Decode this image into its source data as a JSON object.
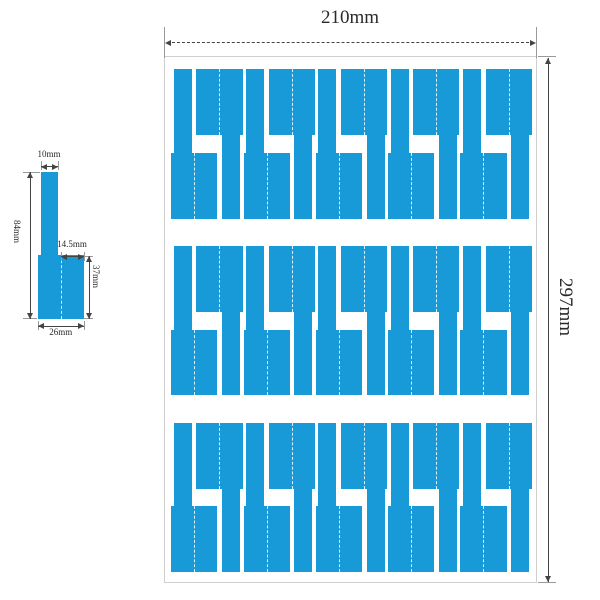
{
  "colors": {
    "label_blue": "#1899d8",
    "sheet_border": "#cfcfcf",
    "dim_line": "#444444",
    "witness_line": "#999999",
    "text": "#2a2a2a",
    "fold_dash": "rgba(255,255,255,0.85)"
  },
  "detail_view": {
    "dim_stem_width": "10mm",
    "dim_total_height": "84mm",
    "dim_stem_to_edge": "14.5mm",
    "dim_flag_height": "37mm",
    "dim_flag_width": "26mm"
  },
  "sheet_view": {
    "dim_width": "210mm",
    "dim_height": "297mm",
    "rows": 3,
    "labels_per_row": 10,
    "total_labels": 30,
    "geometry_mm": {
      "sheet_width": 210,
      "sheet_height": 297,
      "label_height": 84,
      "flag_width": 26,
      "flag_height": 37,
      "stem_width": 10,
      "stem_inset": 1.5,
      "row_top_margin": 7,
      "row_gap": 15.5,
      "side_margin": 3.5,
      "pair_pitch": 40.7,
      "up_label_offset": 14.2,
      "pairs_per_row": 5
    }
  }
}
